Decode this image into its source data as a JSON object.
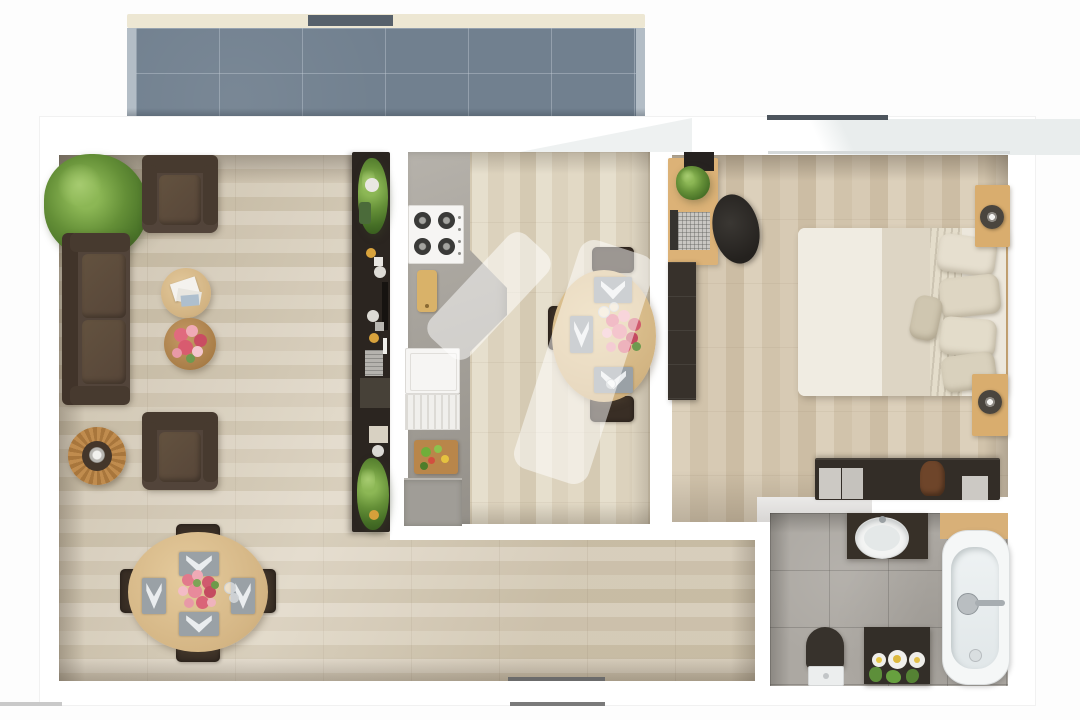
{
  "scene": {
    "type": "apartment-floor-plan-render",
    "description": "Top-down 3D rendering of a one-bedroom apartment floor plan with balcony, no visible text",
    "visible_text": "none"
  },
  "watermark": {
    "present": true,
    "shape": "two translucent diagonal rounded bands",
    "color": "rgba(255,255,255,0.5)"
  },
  "rooms": {
    "balcony": {
      "label": "Balcony",
      "features": [
        "slate blue tile floor",
        "cream railing with dark door gap"
      ]
    },
    "living_room": {
      "label": "Living / Dining Room",
      "furniture": [
        "palm plant",
        "brown armchair (top)",
        "brown sofa",
        "round coffee table with books",
        "round coffee table with flowers",
        "rattan side table with lamp",
        "brown armchair (bottom)",
        "oval dining table with four chairs, placemats and flower bouquet",
        "dark media shelf with plants and dishes"
      ]
    },
    "kitchen": {
      "label": "Kitchen",
      "furniture": [
        "concrete counter",
        "gas hob with four burners",
        "wooden cutting board",
        "dishwasher",
        "prep board with vegetables",
        "grey base cabinet",
        "oval breakfast table with three chairs, placemats and flowers"
      ]
    },
    "bedroom": {
      "label": "Bedroom",
      "furniture": [
        "desk with laptop and plant",
        "black office chair",
        "dark wardrobe",
        "double bed with striped duvet and pillows",
        "two wooden nightstands with lamps",
        "dark sideboard with trays and leather bag"
      ]
    },
    "bathroom": {
      "label": "Bathroom",
      "furniture": [
        "dark vanity with oval sink",
        "bathtub with wall faucet",
        "toilet with dark lid",
        "dark cabinet with daisy vases and plants"
      ]
    }
  },
  "palette": {
    "background": "#fdfdfd",
    "wall": "#ffffff",
    "balcony_tile": "#71808f",
    "railing": "#ede7d3",
    "wood_floor": "#d8cdba",
    "concrete": "#aca8a2",
    "sofa_brown": "#52443a",
    "dark_furniture": "#2b2520",
    "table_wood": "#d8b98c",
    "accent_flowers": "#e06a7e",
    "plant_green": "#648f37"
  }
}
